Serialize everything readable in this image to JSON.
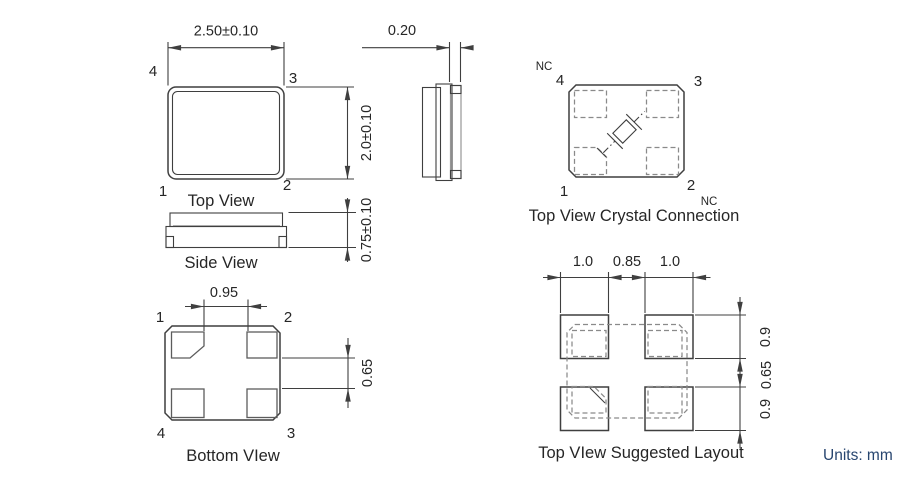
{
  "units_note": "Units: mm",
  "colors": {
    "line": "#3f3f3f",
    "secondary": "#8a8a8a",
    "units_text": "#27456f"
  },
  "top_view": {
    "caption": "Top View",
    "dim_width": "2.50±0.10",
    "dim_height": "2.0±0.10",
    "pin_tl": "4",
    "pin_tr": "3",
    "pin_bl": "1",
    "pin_br": "2"
  },
  "end_view": {
    "dim_lid_thickness": "0.20"
  },
  "side_view": {
    "caption": "Side View",
    "dim_height": "0.75±0.10"
  },
  "bottom_view": {
    "caption": "Bottom VIew",
    "dim_pad_pitch": "0.95",
    "dim_pad_gap": "0.65",
    "pin_tl": "1",
    "pin_tr": "2",
    "pin_bl": "4",
    "pin_br": "3"
  },
  "crystal_connection": {
    "caption": "Top View Crystal Connection",
    "pin_tl": "4",
    "pin_tr": "3",
    "pin_bl": "1",
    "pin_br": "2",
    "nc_top": "NC",
    "nc_bottom": "NC"
  },
  "suggested_layout": {
    "caption": "Top VIew Suggested Layout",
    "dims_top": [
      "1.0",
      "0.85",
      "1.0"
    ],
    "dims_right": [
      "0.9",
      "0.65",
      "0.9"
    ]
  }
}
